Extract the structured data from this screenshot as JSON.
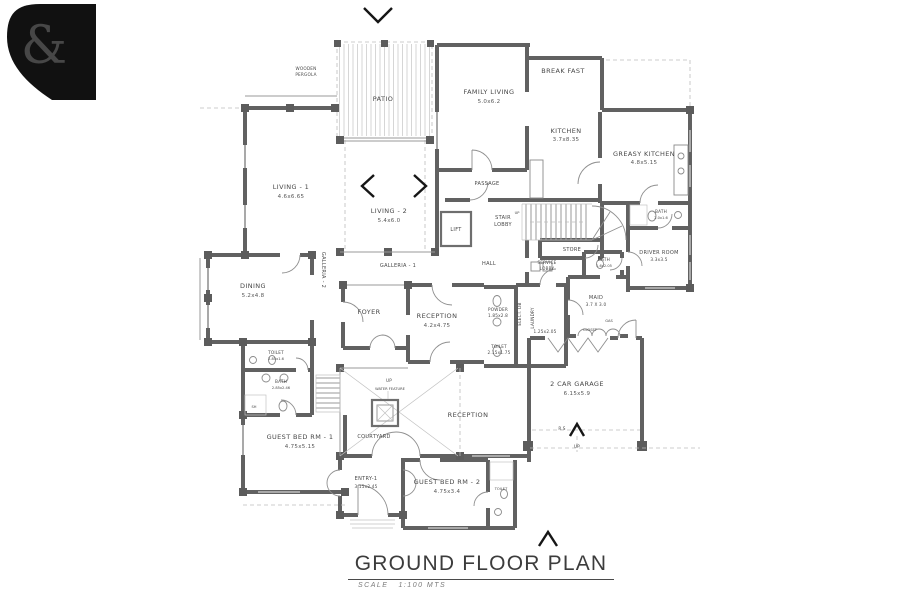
{
  "title": {
    "heading": "GROUND FLOOR PLAN",
    "scale_label": "SCALE",
    "scale_value": "1:100 MTS"
  },
  "logo": {
    "glyph": "&",
    "bg": "#111111",
    "fg": "#ffffff"
  },
  "colors": {
    "wall": "#616161",
    "text": "#474747",
    "accent": "#161616"
  },
  "annotations": {
    "up": "UP",
    "rs": "R.S",
    "water_feature": "WATER FEATURE"
  },
  "rooms": {
    "pergola": {
      "lines": [
        "WOODEN",
        "PERGOLA"
      ]
    },
    "patio": {
      "name": "PATIO"
    },
    "family_living": {
      "name": "FAMILY LIVING",
      "dims": "5.0x6.2"
    },
    "breakfast": {
      "name": "BREAK FAST"
    },
    "kitchen": {
      "name": "KITCHEN",
      "dims": "3.7x8.35"
    },
    "greasy_kitchen": {
      "name": "GREASY KITCHEN",
      "dims": "4.8x5.15"
    },
    "living1": {
      "name": "LIVING - 1",
      "dims": "4.6x6.65"
    },
    "living2": {
      "name": "LIVING - 2",
      "dims": "5.4x6.0"
    },
    "passage": {
      "name": "PASSAGE"
    },
    "lift": {
      "name": "LIFT"
    },
    "stair_lobby": {
      "lines": [
        "STAIR",
        "LOBBY"
      ]
    },
    "store": {
      "name": "STORE"
    },
    "hall": {
      "name": "HALL"
    },
    "service_lobby": {
      "lines": [
        "SERVICE",
        "LOBBY"
      ]
    },
    "dining": {
      "name": "DINING",
      "dims": "5.2x4.8"
    },
    "galleria1": {
      "name": "GALLERIA - 1"
    },
    "galleria2": {
      "name": "GALLERIA - 2"
    },
    "foyer": {
      "name": "FOYER"
    },
    "reception1": {
      "name": "RECEPTION",
      "dims": "4.2x4.75"
    },
    "reception2": {
      "name": "RECEPTION"
    },
    "powder": {
      "name": "POWDER",
      "dims": "1.85x2.8"
    },
    "toilet_powder": {
      "name": "TOILET",
      "dims": "2.15x1.75"
    },
    "elect_db": {
      "name": "ELECT. DB"
    },
    "laundry": {
      "name": "LAUNDRY",
      "dims": "1.25x2.05"
    },
    "maid": {
      "name": "MAID",
      "dims": "3.7 X 3.0"
    },
    "bath_maid": {
      "name": "BATH",
      "dims": "1.6x2.05"
    },
    "driver_room": {
      "name": "DRIVER ROOM",
      "dims": "3.3x3.5"
    },
    "bath_driver": {
      "name": "BATH",
      "dims": "2.0x1.6"
    },
    "garage": {
      "name": "2 CAR GARAGE",
      "dims": "6.15x5.9"
    },
    "toilet_guest1": {
      "name": "TOILET",
      "dims": "2.85x1.6"
    },
    "bath_guest1": {
      "name": "BATH",
      "dims": "2.85x2.46"
    },
    "shower": {
      "name": "SH"
    },
    "guest_bed1": {
      "name": "GUEST BED RM - 1",
      "dims": "4.75x5.15"
    },
    "courtyard": {
      "name": "COURTYARD"
    },
    "entry1": {
      "name": "ENTRY-1",
      "dims": "3.15x2.45"
    },
    "guest_bed2": {
      "name": "GUEST BED RM - 2",
      "dims": "4.75x3.4"
    },
    "toilet_guest2": {
      "name": "TOILET"
    },
    "closet": {
      "name": "CLOSET"
    },
    "gas": {
      "name": "GAS"
    }
  }
}
